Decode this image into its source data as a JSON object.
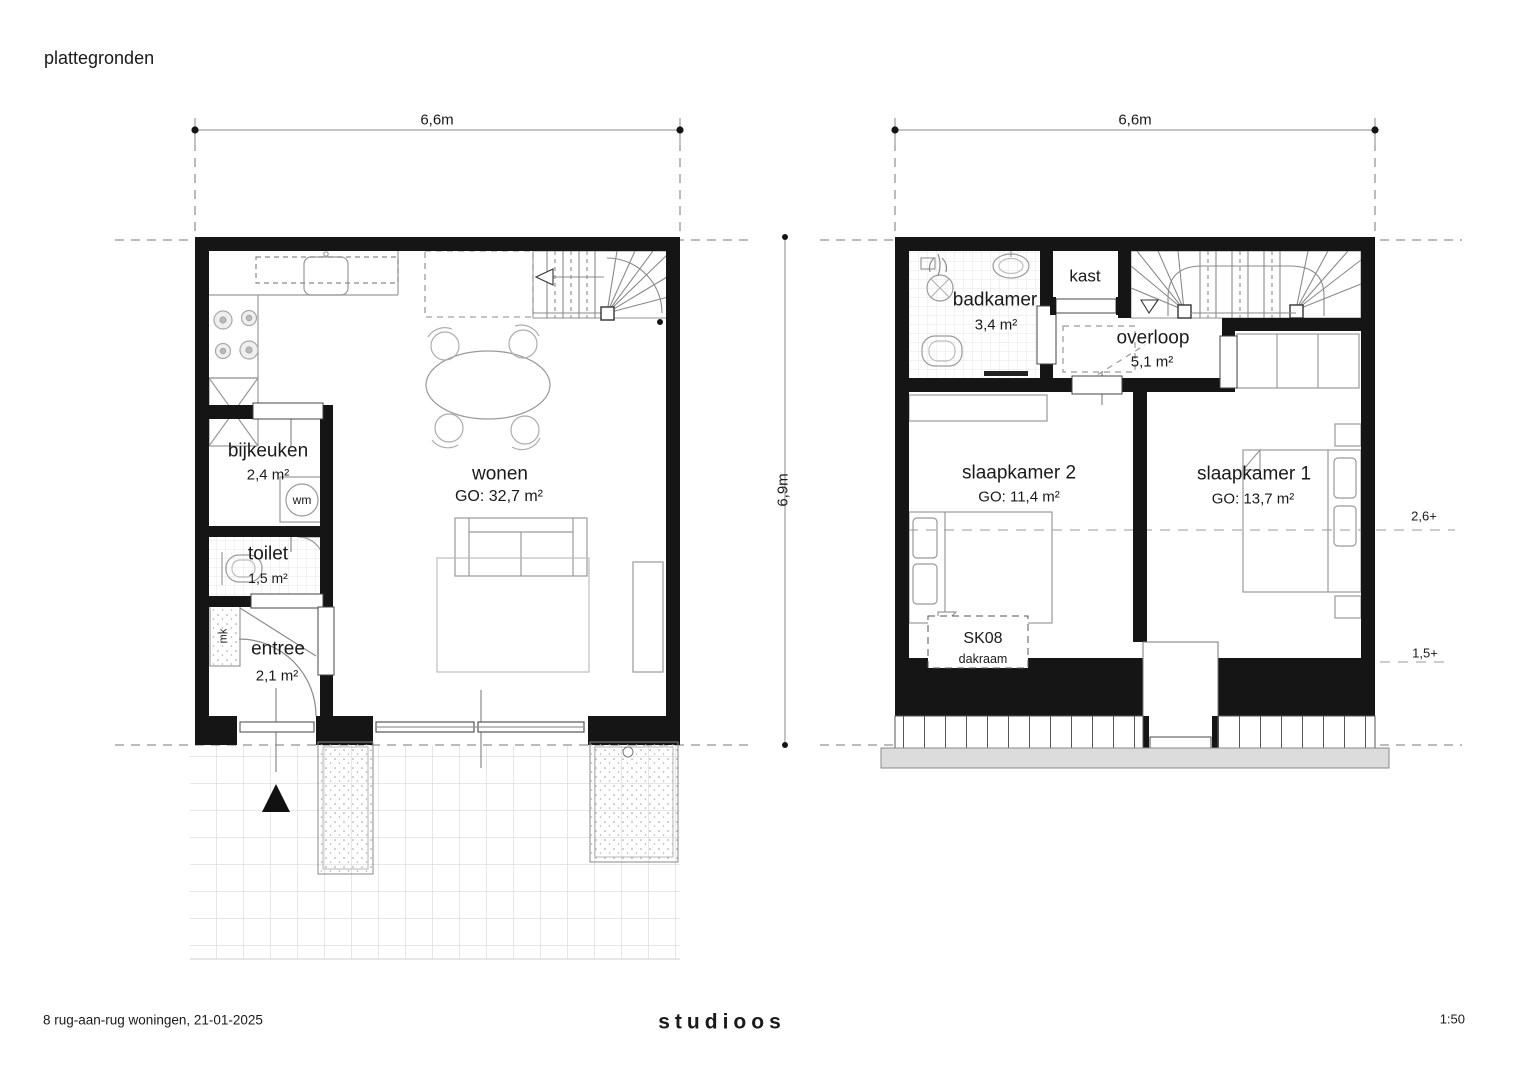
{
  "title": "plattegronden",
  "dimensions": {
    "ground_width": "6,6m",
    "upper_width": "6,6m",
    "depth": "6,9m"
  },
  "ground_floor": {
    "bijkeuken": {
      "name": "bijkeuken",
      "area": "2,4 m²"
    },
    "toilet": {
      "name": "toilet",
      "area": "1,5 m²"
    },
    "entree": {
      "name": "entree",
      "area": "2,1 m²"
    },
    "wonen": {
      "name": "wonen",
      "area": "GO: 32,7 m²"
    },
    "washing_machine": "wm",
    "meter_cupboard": "mk"
  },
  "upper_floor": {
    "badkamer": {
      "name": "badkamer",
      "area": "3,4 m²"
    },
    "kast": {
      "name": "kast"
    },
    "overloop": {
      "name": "overloop",
      "area": "5,1 m²"
    },
    "slaapkamer2": {
      "name": "slaapkamer 2",
      "area": "GO: 11,4 m²"
    },
    "slaapkamer1": {
      "name": "slaapkamer 1",
      "area": "GO: 13,7 m²"
    },
    "skylight": {
      "code": "SK08",
      "type": "dakraam"
    },
    "levels": {
      "upper": "2,6+",
      "lower": "1,5+"
    }
  },
  "footer": {
    "project": "8 rug-aan-rug woningen, 21-01-2025",
    "studio": "studioos",
    "scale": "1:50"
  }
}
